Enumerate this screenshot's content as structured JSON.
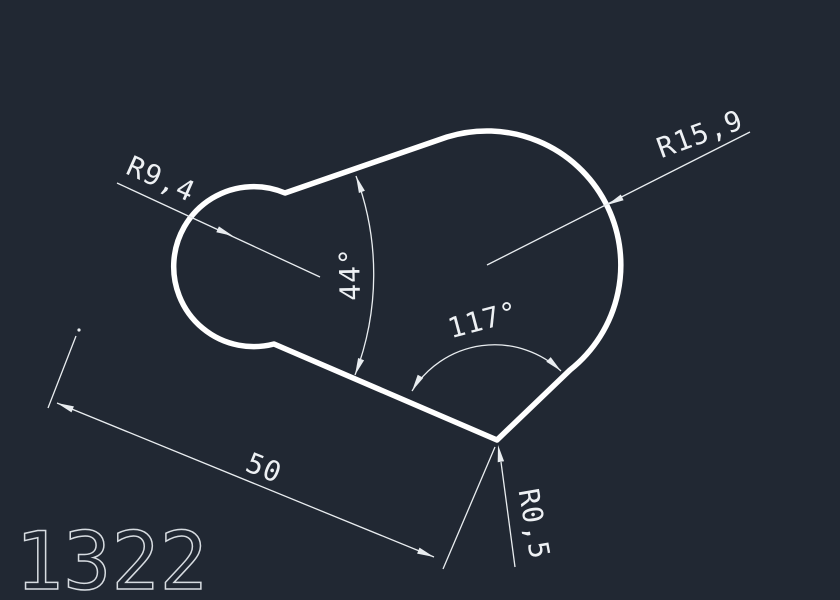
{
  "theme": {
    "background": "#212833",
    "outline": "#ffffff",
    "dim": "#e9edf0",
    "dim_text": "#eef1f4",
    "number": "#d7dce1"
  },
  "drawing": {
    "number": "1322",
    "dimensions": {
      "radius_left": "R9,4",
      "radius_right": "R15,9",
      "angle_small": "44°",
      "angle_large": "117°",
      "length": "50",
      "corner_radius": "R0,5"
    }
  }
}
